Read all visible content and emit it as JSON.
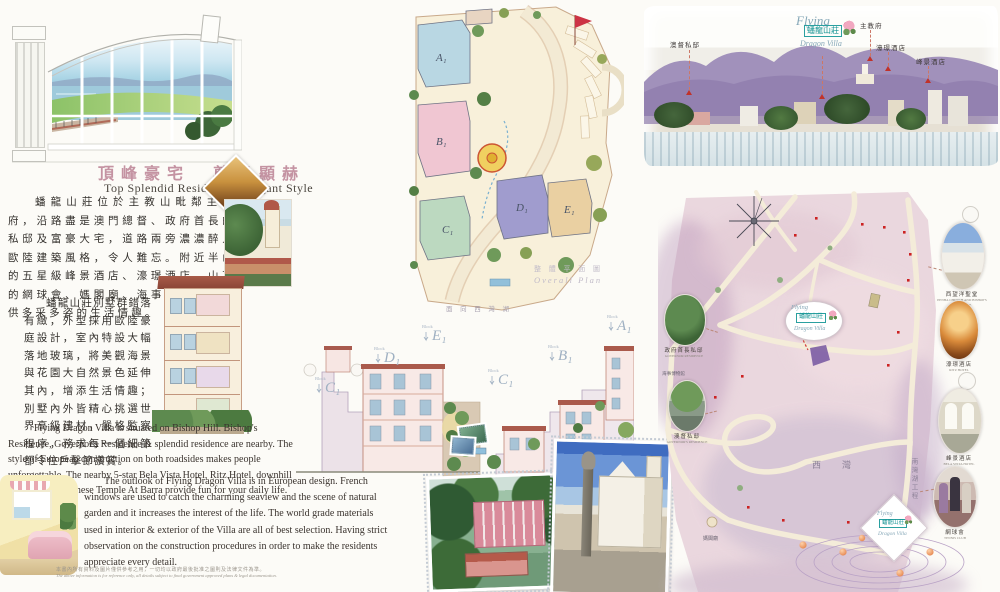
{
  "brand": {
    "flying": "Flying",
    "dragon_villa": "Dragon Villa",
    "name_zh": "蟠龍山莊"
  },
  "header": {
    "title_zh": "頂峰豪宅　尊貴顯赫",
    "title_en": "Top Splendid Residence / Elegant Style"
  },
  "intro": {
    "zh_p1": "蟠龍山莊位於主教山毗鄰主教府，沿路盡是澳門總督、政府首長的私邸及富豪大宅，道路兩旁濃濃醉人歐陸建築風格，令人難忘。附近半山的五星級峰景酒店、濠璟酒店、山下的網球會、媽閣廟、海事博物館，提供多采多姿的生活情趣。",
    "zh_p2": "蟠龍山莊別墅群錯落有緻，外型採用歐陸豪庭設計，室內特設大幅落地玻璃，將美觀海景與花園大自然景色延伸其內，增添生活情趣；別墅內外皆精心挑選世界高級建材，嚴格監察程序，務求每一個細節都令住戶擊節讚賞。",
    "en_p1": "Flying Dragon Villa is situated on Bishop Hill. Bishop's Residence, Governor's Residence & splendid residence are nearby. The style of European construction on both roadsides makes people unforgettable. The nearby 5-star Bela Vista Hotel, Ritz Hotel, downhill Tennis Club, Chinese Temple At Barra provide fun for your daily life.",
    "en_p2": "The outlook of Flying Dragon Villa is in European design. French windows are used to catch the charming seaview and the scene of natural garden and it increases the interest of the life.  The world grade materials used in interior & exterior of the Villa are all of best selection. Having strict observation on the construction procedures in order to make the residents appreciate every detail."
  },
  "disclaimer": {
    "zh": "本書內所有資料及圖片僅供參考之用，一切均以政府最後批准之圖則及法律文件為準。",
    "en": "The above information is for reference only, all details subject to final government approved plans & legal documentation."
  },
  "site_plan": {
    "title_zh": "整 體 平 面 圖",
    "title_en": "Overall Plan",
    "facing_label": "面 向 西 灣 湖",
    "blocks": [
      {
        "label": "A₁"
      },
      {
        "label": "B₁"
      },
      {
        "label": "C₁"
      },
      {
        "label": "D₁"
      },
      {
        "label": "E₁"
      }
    ]
  },
  "elevations": {
    "prefix": "Block",
    "left": [
      "C₁",
      "D₁",
      "E₁"
    ],
    "right": [
      "C₁",
      "B₁",
      "A₁"
    ]
  },
  "panorama": {
    "labels": [
      "澳督私邸",
      "主教府",
      "濠璟酒店",
      "峰景酒店"
    ]
  },
  "map": {
    "sai_van": "西　灣",
    "nam_van_project": "南灣湖工程",
    "ma_kok_temple": "媽閣廟",
    "maritime_museum": "海事博物館",
    "callouts_left": [
      {
        "zh": "政府首長私邸",
        "en": "GOVERNOR RESIDENCE"
      },
      {
        "zh": "澳督私邸",
        "en": "GOVERNOR'S RESIDENCE"
      }
    ],
    "callouts_right": [
      {
        "zh": "西望洋聖堂",
        "en": "PENHA CHURCH AND BISHOP'S RESIDENCE"
      },
      {
        "zh": "濠璟酒店",
        "en": "RITZ HOTEL"
      },
      {
        "zh": "峰景酒店",
        "en": "BELA VISTA HOTEL"
      },
      {
        "zh": "網球會",
        "en": "TENNIS CLUB"
      }
    ]
  }
}
